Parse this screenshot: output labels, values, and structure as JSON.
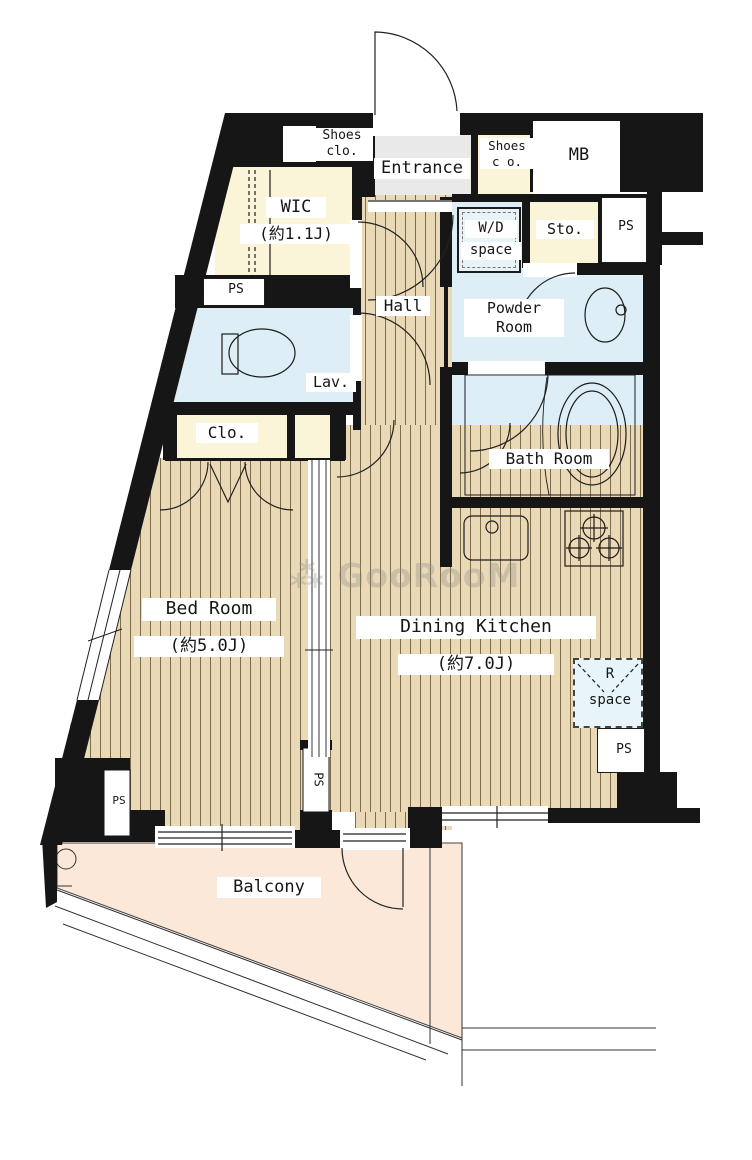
{
  "title": "1DK apartment floor plan",
  "watermark": {
    "icon": "⁂",
    "text": "GooRooM"
  },
  "colors": {
    "wall": "#161616",
    "room_cream": "#faf5d9",
    "wet_area_blue": "#ddeef6",
    "wood_floor": "#ead9b6",
    "balcony_peach": "#fbe8d9",
    "entrance_gray": "#e9e9e9"
  },
  "labels": {
    "entrance": "Entrance",
    "shoes_left_1": "Shoes",
    "shoes_left_2": "clo.",
    "shoes_right_1": "Shoes",
    "shoes_right_2": "c o.",
    "mb": "MB",
    "wic": "WIC",
    "wic_size": "(約1.1J)",
    "wd_1": "W/D",
    "wd_2": "space",
    "sto": "Sto.",
    "ps": "PS",
    "hall": "Hall",
    "powder_1": "Powder",
    "powder_2": "Room",
    "lav": "Lav.",
    "bath": "Bath Room",
    "clo": "Clo.",
    "bed": "Bed Room",
    "bed_size": "(約5.0J)",
    "dk": "Dining Kitchen",
    "dk_size": "(約7.0J)",
    "r_1": "R",
    "r_2": "space",
    "balcony": "Balcony"
  }
}
